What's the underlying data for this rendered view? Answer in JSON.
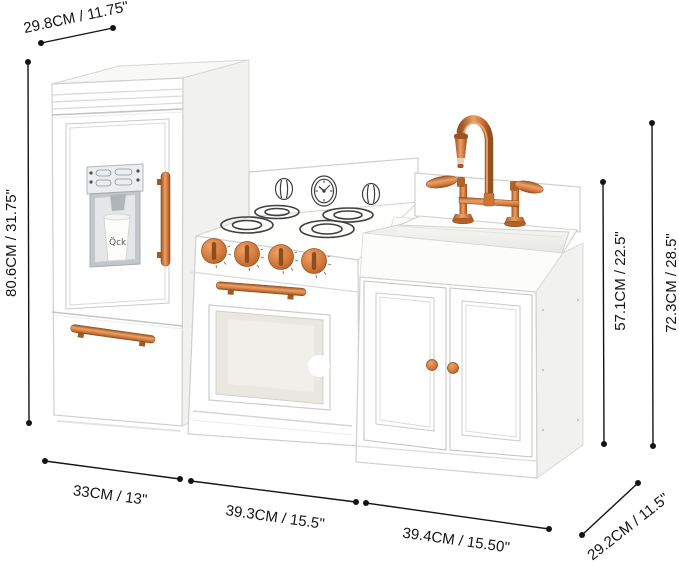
{
  "meta": {
    "description": "Product dimension diagram of a white play kitchen with copper accents (fridge, stove, sink unit)",
    "background": "#ffffff"
  },
  "colors": {
    "annotation_line": "#141414",
    "copper": "#cd7437",
    "copper_light": "#f0a870",
    "copper_dark": "#8f4d1e",
    "panel_outline": "#cccccc",
    "side_shade": "#f1f1f0",
    "unit_white": "#ffffff",
    "detail_linework": "#3f3f3f",
    "dispenser_silver": "#c3c7ca"
  },
  "dimensions": {
    "top_depth": "29.8CM / 11.75\"",
    "fridge_height": "80.6CM / 31.75\"",
    "fridge_width": "33CM / 13\"",
    "stove_width": "39.3CM / 15.5\"",
    "sink_width": "39.4CM / 15.50\"",
    "base_depth": "29.2CM / 11.5\"",
    "sink_height": "57.1CM / 22.5\"",
    "total_height": "72.3CM / 28.5\""
  },
  "details": {
    "cup_doodle": "Q̈ck"
  }
}
